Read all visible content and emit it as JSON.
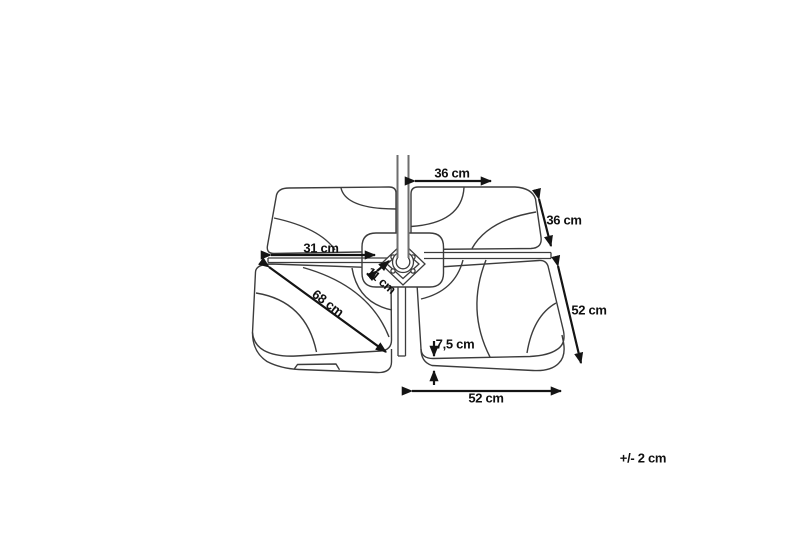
{
  "diagram": {
    "subject": "parasol-base-weight-plates-dimension-drawing",
    "colors": {
      "outline": "#3c3c3c",
      "pole": "#6e6e6e",
      "dimension": "#141414",
      "background": "#ffffff"
    },
    "dimensions": [
      {
        "id": "plate-top-width",
        "label": "36 cm"
      },
      {
        "id": "plate-side-depth",
        "label": "36 cm"
      },
      {
        "id": "left-arm-length",
        "label": "31 cm"
      },
      {
        "id": "hub-width",
        "label": "11 cm"
      },
      {
        "id": "plate-diagonal",
        "label": "68 cm"
      },
      {
        "id": "plate-right-depth",
        "label": "52 cm"
      },
      {
        "id": "plate-thickness",
        "label": "7,5 cm"
      },
      {
        "id": "plate-bottom-width",
        "label": "52 cm"
      }
    ],
    "tolerance": {
      "label": "+/- 2 cm"
    }
  }
}
